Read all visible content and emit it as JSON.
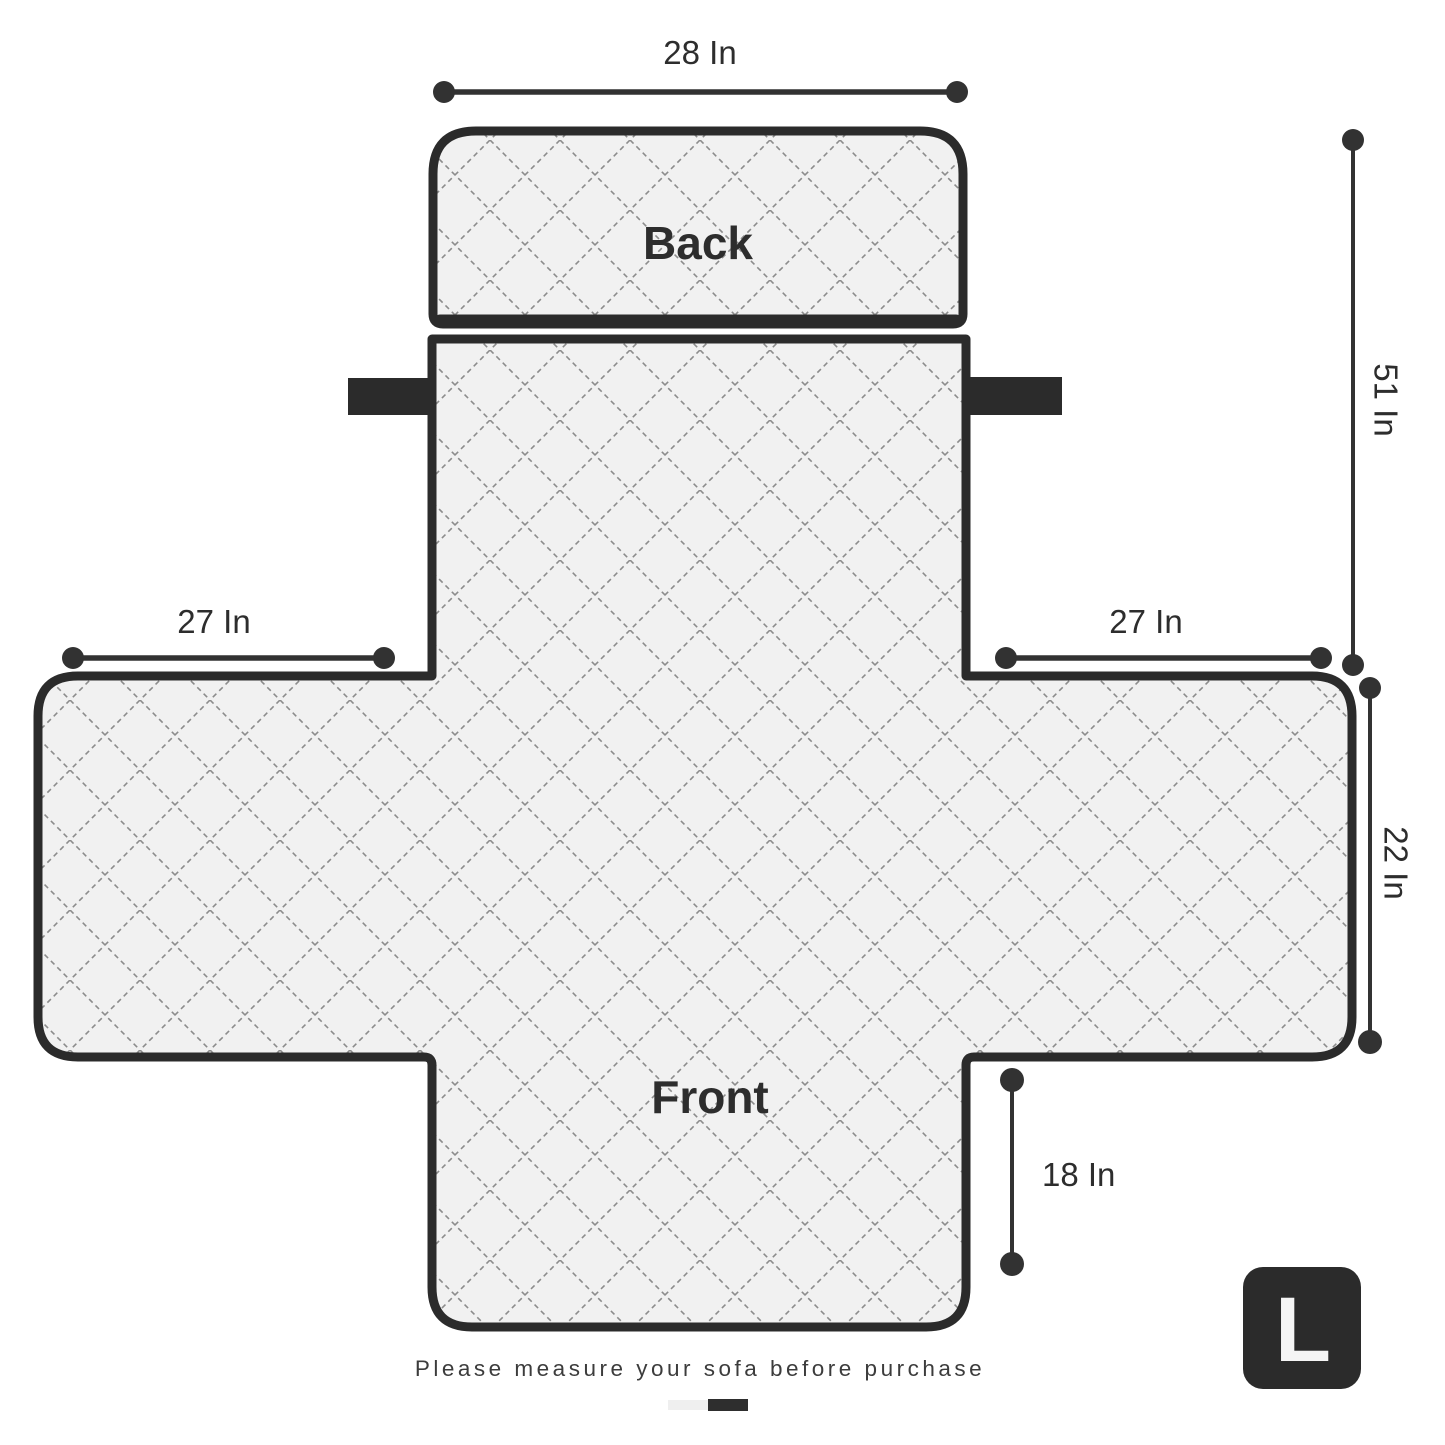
{
  "product_diagram": {
    "labels": {
      "back": "Back",
      "front": "Front"
    },
    "measurements": {
      "back_width": "28 In",
      "back_total_height": "51 In",
      "left_arm_width": "27 In",
      "right_arm_width": "27 In",
      "right_side_height": "22 In",
      "front_skirt_height": "18 In"
    },
    "footer": {
      "note": "Please measure your sofa before purchase",
      "size_badge": "L"
    },
    "colors": {
      "background": "#ffffff",
      "outline": "#2b2b2b",
      "fabric_fill": "#f1f1f1",
      "stitch_line": "#8c8c8c",
      "dimension_line": "#323232",
      "label_text": "#2d2d2d",
      "note_text": "#3c3c3c",
      "badge_bg": "#2b2b2b",
      "badge_text": "#f5f5f5",
      "indicator_inactive": "#efefef",
      "indicator_active": "#2e2e2e"
    }
  }
}
